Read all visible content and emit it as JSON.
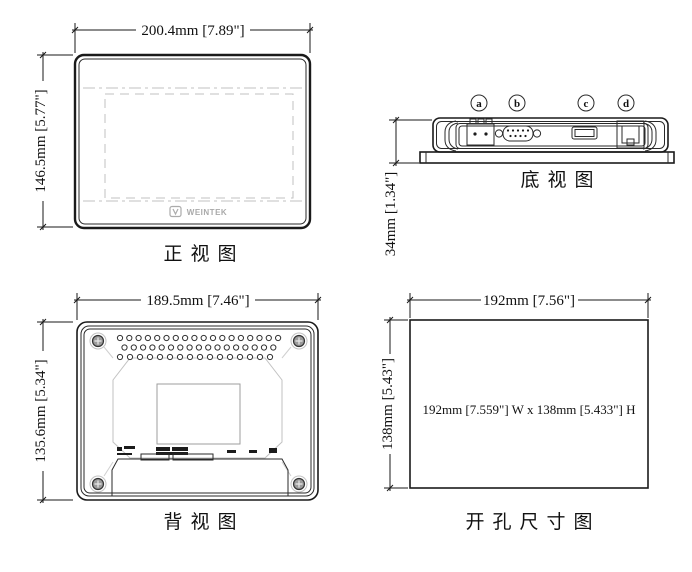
{
  "drawing": {
    "views": {
      "front": {
        "label": "正视图",
        "width_dim": "200.4mm [7.89\"]",
        "height_dim": "146.5mm [5.77\"]",
        "logo_text": "WEINTEK"
      },
      "bottom": {
        "label": "底视图",
        "height_dim": "34mm [1.34\"]",
        "ports": [
          {
            "id": "a"
          },
          {
            "id": "b"
          },
          {
            "id": "c"
          },
          {
            "id": "d"
          }
        ]
      },
      "back": {
        "label": "背视图",
        "width_dim": "189.5mm [7.46\"]",
        "height_dim": "135.6mm [5.34\"]"
      },
      "cutout": {
        "label": "开孔尺寸图",
        "width_dim": "192mm [7.56\"]",
        "height_dim": "138mm [5.43\"]",
        "note": "192mm [7.559\"] W x 138mm [5.433\"] H"
      }
    },
    "colors": {
      "line": "#1a1a1a",
      "light_line": "#c2c2c2",
      "background": "#ffffff"
    }
  }
}
